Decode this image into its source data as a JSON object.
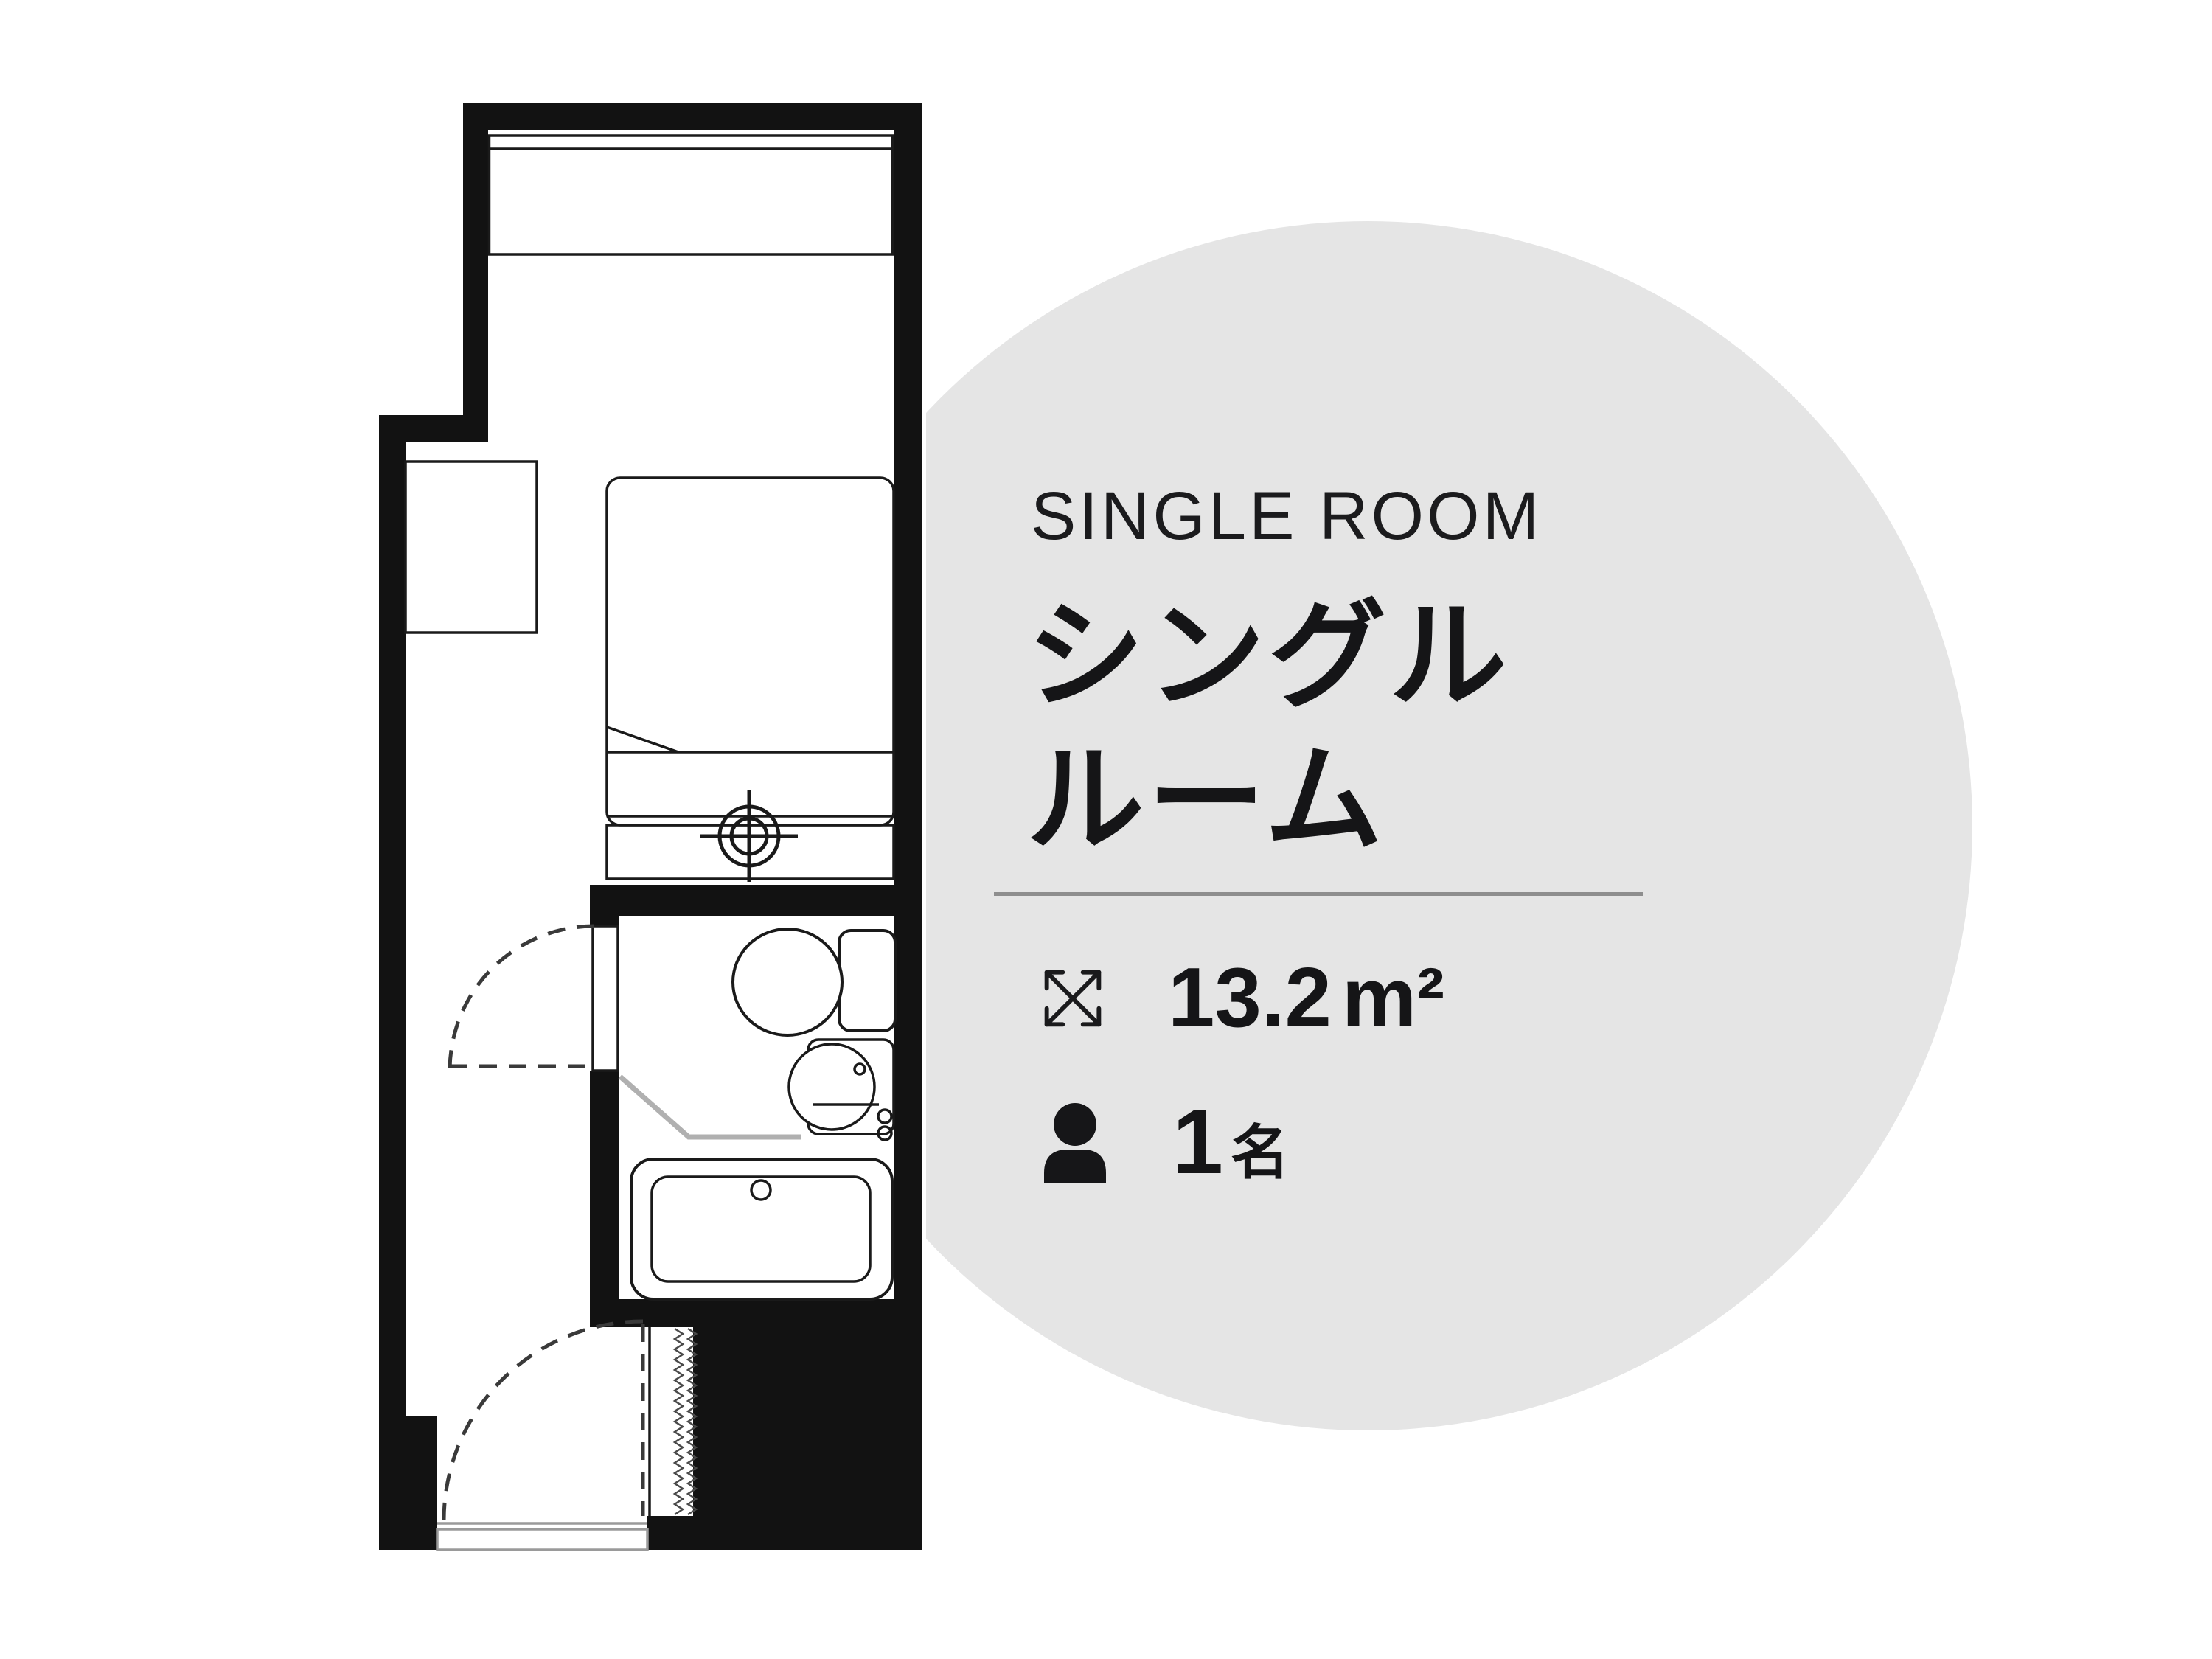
{
  "page": {
    "background": "#ffffff"
  },
  "accent_circle": {
    "color": "#e5e5e5"
  },
  "panel": {
    "eyebrow": "SINGLE ROOM",
    "title": {
      "line1": "シングル",
      "line2": "ルーム"
    },
    "divider_color": "#8e8e8e",
    "text_color": "#151517",
    "specs": [
      {
        "icon": "expand-arrows-icon",
        "value": "13.2",
        "unit": "m²"
      },
      {
        "icon": "person-icon",
        "value": "1",
        "unit": "名"
      }
    ]
  },
  "floorplan": {
    "ink_color": "#121212",
    "features": [
      "window",
      "closet-box",
      "single-bed",
      "bed-sheet-fold",
      "foot-counter",
      "ceiling-light-crosshair-symbol",
      "unit-bathroom",
      "toilet",
      "washbasin",
      "bathtub",
      "bathroom-door-swing-dashed",
      "entrance-door-swing-dashed",
      "entrance-step",
      "pipe-shaft-zigzag"
    ]
  }
}
